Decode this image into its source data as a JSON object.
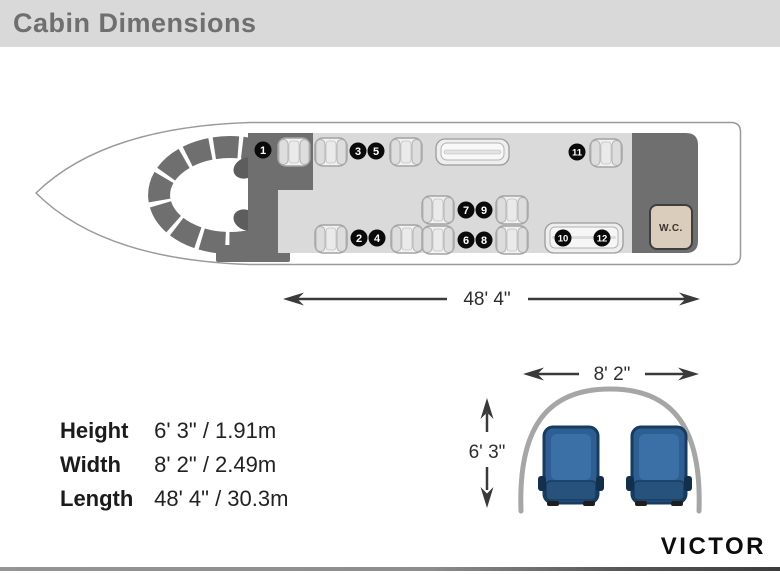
{
  "header": {
    "title": "Cabin Dimensions"
  },
  "floorplan": {
    "wc_label": "W.C.",
    "seat_numbers": [
      "1",
      "2",
      "3",
      "4",
      "5",
      "6",
      "7",
      "8",
      "9",
      "10",
      "11",
      "12"
    ],
    "length_label": "48' 4\""
  },
  "cross_section": {
    "width_label": "8' 2\"",
    "height_label": "6' 3\""
  },
  "specs": {
    "rows": [
      {
        "label": "Height",
        "value": "6' 3\" / 1.91m"
      },
      {
        "label": "Width",
        "value": "8' 2\" / 2.49m"
      },
      {
        "label": "Length",
        "value": "48' 4\" / 30.3m"
      }
    ]
  },
  "brand": {
    "name": "VICTOR"
  },
  "colors": {
    "header_bg": "#d9d9d9",
    "interior_dark_gray": "#6f6f6f",
    "floor_gray": "#dadada",
    "seat_blue": "#2e5f92",
    "outline_gray": "#9a9a9a"
  }
}
